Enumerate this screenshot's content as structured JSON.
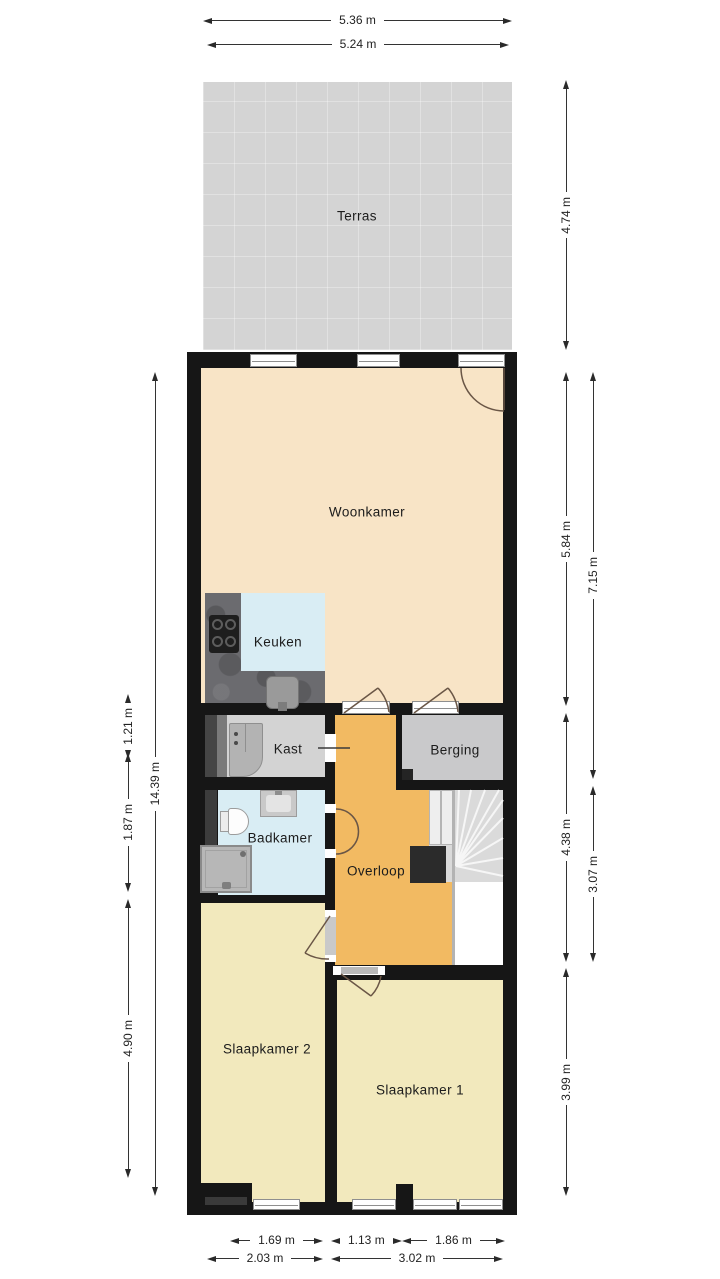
{
  "rooms": {
    "terras": "Terras",
    "woonkamer": "Woonkamer",
    "keuken": "Keuken",
    "kast": "Kast",
    "berging": "Berging",
    "badkamer": "Badkamer",
    "overloop": "Overloop",
    "slaapkamer2": "Slaapkamer 2",
    "slaapkamer1": "Slaapkamer 1"
  },
  "dimensions": {
    "top": [
      "5.36 m",
      "5.24 m"
    ],
    "left": [
      "14.39 m",
      "1.21 m",
      "1.87 m",
      "4.90 m"
    ],
    "right": [
      "4.74 m",
      "5.84 m",
      "7.15 m",
      "4.38 m",
      "3.07 m",
      "3.99 m"
    ],
    "bottom_row1": [
      "1.69 m",
      "1.13 m",
      "1.86 m"
    ],
    "bottom_row2": [
      "2.03 m",
      "3.02 m"
    ]
  },
  "colors": {
    "wall": "#161616",
    "terras": "#d4d4d4",
    "woonkamer_floor": "#f8e4c6",
    "slaapkamer_floor": "#f2e9bd",
    "keuken_badkamer_floor": "#d9edf4",
    "overloop_floor": "#f2ba62",
    "kast_floor": "#d3d3d3",
    "berging_floor": "#c9c9cb",
    "counter": "#6b6b6f",
    "stairs": "#dadada"
  }
}
